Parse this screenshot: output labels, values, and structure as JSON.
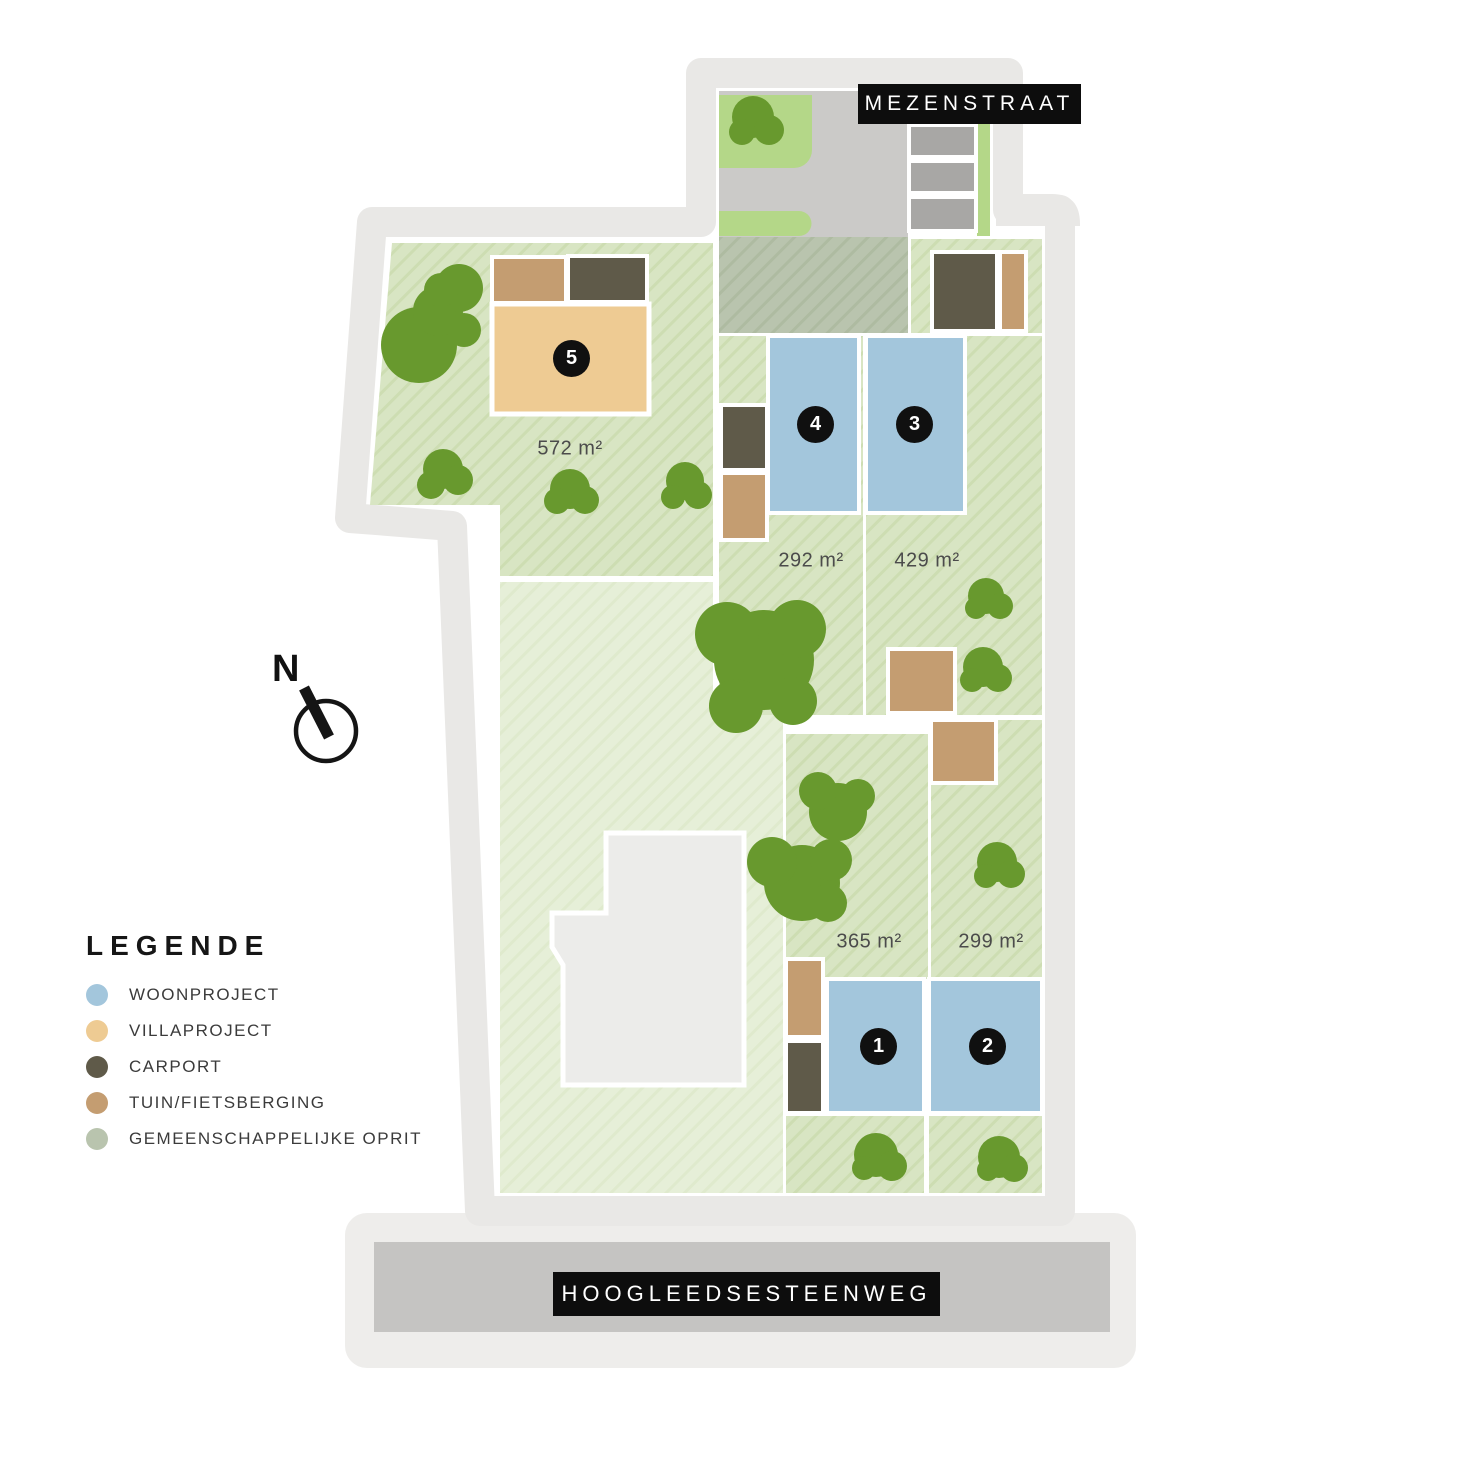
{
  "streets": {
    "top": "MEZENSTRAAT",
    "bottom": "HOOGLEEDSESTEENWEG"
  },
  "compass": {
    "north_label": "N"
  },
  "legend": {
    "title": "LEGENDE",
    "items": [
      {
        "key": "woonproject",
        "label": "WOONPROJECT",
        "color": "#a3c6dc"
      },
      {
        "key": "villaproject",
        "label": "VILLAPROJECT",
        "color": "#eecb93"
      },
      {
        "key": "carport",
        "label": "CARPORT",
        "color": "#5f5a49"
      },
      {
        "key": "tuin-fietsberging",
        "label": "TUIN/FIETSBERGING",
        "color": "#c49d71"
      },
      {
        "key": "gemeenschappelijke-oprit",
        "label": "GEMEENSCHAPPELIJKE OPRIT",
        "color": "#b9c4ae"
      }
    ]
  },
  "lots": [
    {
      "number": "1",
      "area": "365 m²"
    },
    {
      "number": "2",
      "area": "299 m²"
    },
    {
      "number": "3",
      "area": "429 m²"
    },
    {
      "number": "4",
      "area": "292 m²"
    },
    {
      "number": "5",
      "area": "572 m²"
    }
  ],
  "colors": {
    "woonproject": "#a3c6dc",
    "villaproject": "#eecb93",
    "carport": "#5f5a49",
    "tuin": "#c49d71",
    "oprit": "#b9c4ae",
    "tree": "#68992e"
  }
}
